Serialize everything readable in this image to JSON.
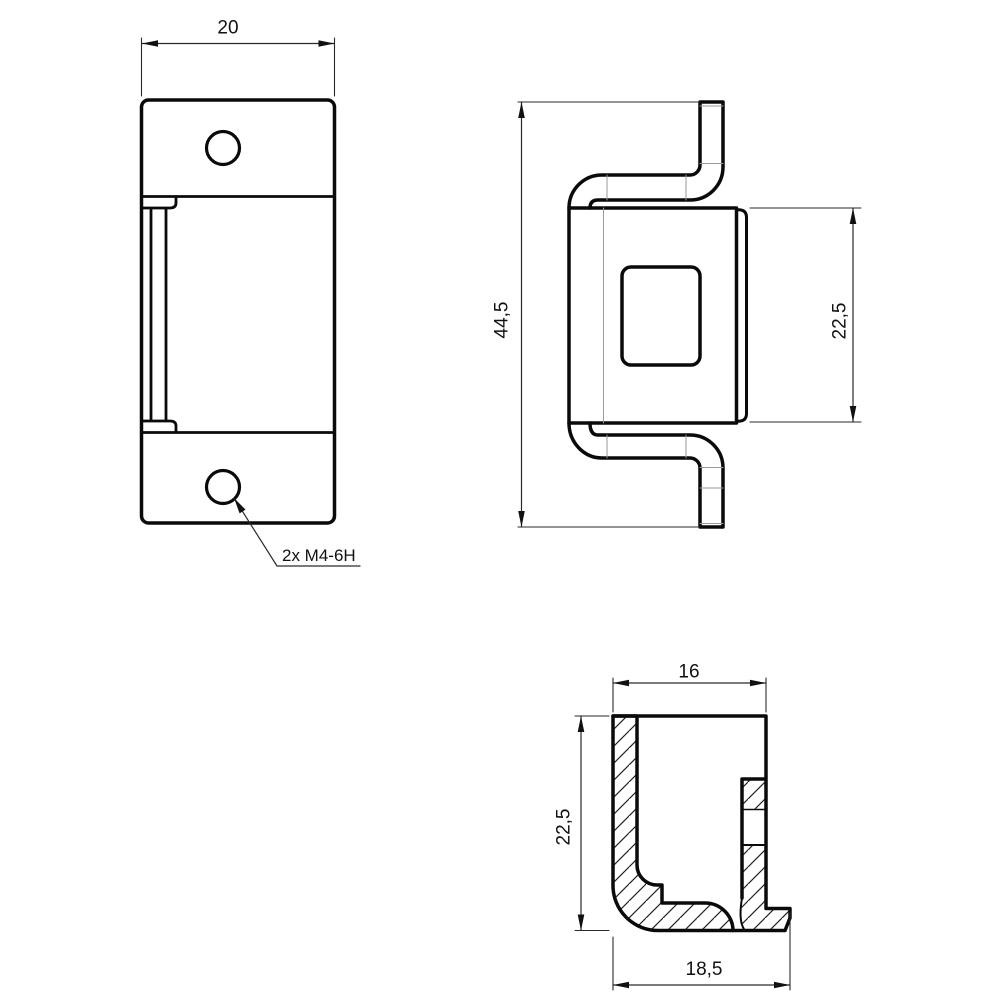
{
  "colors": {
    "background": "#ffffff",
    "outline": "#0a0a0a",
    "dim_line": "#2a2a2a",
    "thin_line": "#9a9a9a"
  },
  "dimensions": {
    "front_width": "20",
    "thread_callout": "2x M4-6H",
    "side_overall_height": "44,5",
    "side_body_height": "22,5",
    "section_top_width": "16",
    "section_height": "22,5",
    "section_bottom_width": "18,5"
  }
}
